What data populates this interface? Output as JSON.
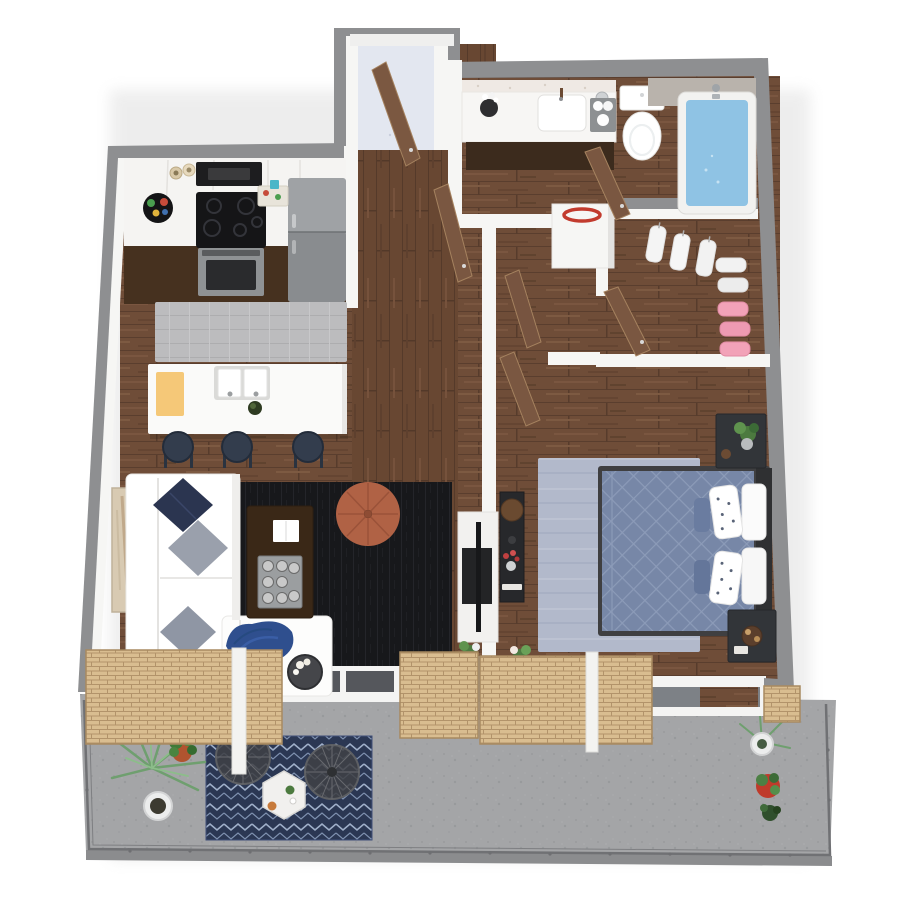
{
  "scene": {
    "description": "3D rendered top-down floor plan of a one-bedroom apartment with a long balcony",
    "view": "bird's-eye 3D render",
    "background_color": "#ffffff",
    "visible_text": []
  },
  "palette": {
    "exterior_wall_gray": "#8e8f91",
    "interior_wall_white": "#f6f6f4",
    "wood_floor": "#6f4d38",
    "entry_floor": "#e3e7f0",
    "balcony_concrete": "#a4a5a7",
    "bath_water_blue": "#8fc3e4",
    "bed_duvet_blue": "#7787a7",
    "bedroom_rug": "#b2b9cb",
    "living_rug_black": "#17181b",
    "balcony_rug_navy": "#2b3753",
    "kitchen_runner_gray": "#bcbcbe",
    "door_wood_brown": "#7a5741",
    "pouf_terracotta": "#b06245",
    "stool_navy": "#333d4d",
    "cutting_board_yellow": "#f5c878",
    "closet_pink": "#f2a2b8",
    "lattice_tan": "#d9bd90"
  },
  "rooms": [
    {
      "name": "Kitchen",
      "items": [
        "white upper cabinets",
        "white counter",
        "black cooktop with stainless oven",
        "black microwave",
        "gray refrigerator",
        "round serving tray",
        "two jars",
        "cutting board with food",
        "gray runner rug",
        "white island with double sink",
        "yellow cutting board",
        "avocado",
        "three navy bar stools"
      ]
    },
    {
      "name": "Living Room",
      "items": [
        "L-shaped white sectional sofa",
        "navy pillow",
        "two gray pillows",
        "blue throw blanket",
        "black area rug",
        "dark wood coffee table",
        "white book",
        "tray with eight cups",
        "terracotta pouf",
        "tall beige wall art",
        "white media console with TV",
        "round side table with white flowers"
      ]
    },
    {
      "name": "Entry Hall",
      "items": [
        "open front door",
        "pale entry mat",
        "two open hall doors"
      ]
    },
    {
      "name": "Bathroom",
      "items": [
        "vanity with white counter and dark cabinet",
        "sink with faucet",
        "black vase with white flowers",
        "towel caddy",
        "white toilet",
        "bathtub filled with blue water",
        "shower fixture",
        "gray tile surround",
        "open door"
      ]
    },
    {
      "name": "Laundry Closet",
      "items": [
        "white washer with red lid ring"
      ]
    },
    {
      "name": "Walk-in Closet",
      "items": [
        "three hanging white shirts",
        "two hanging white garments",
        "three hanging pink garments",
        "open door"
      ]
    },
    {
      "name": "Bedroom",
      "items": [
        "double bed with blue diamond-quilt duvet",
        "two polka-dot pillows",
        "two white pillows",
        "dark headboard",
        "two dark nightstands",
        "potted plant",
        "round serving tray",
        "light blue area rug",
        "dark console with red flowers",
        "open door",
        "small window plants"
      ]
    },
    {
      "name": "Balcony",
      "items": [
        "speckled concrete floor",
        "thin metal railing",
        "navy Moroccan-pattern rug",
        "two round wire chairs",
        "white hexagonal side table",
        "palm in white pot",
        "plant in terracotta pot",
        "plant in white pot",
        "plant in red pot",
        "small dark plant",
        "tan wood-slat privacy screens",
        "white frame beams"
      ]
    }
  ]
}
